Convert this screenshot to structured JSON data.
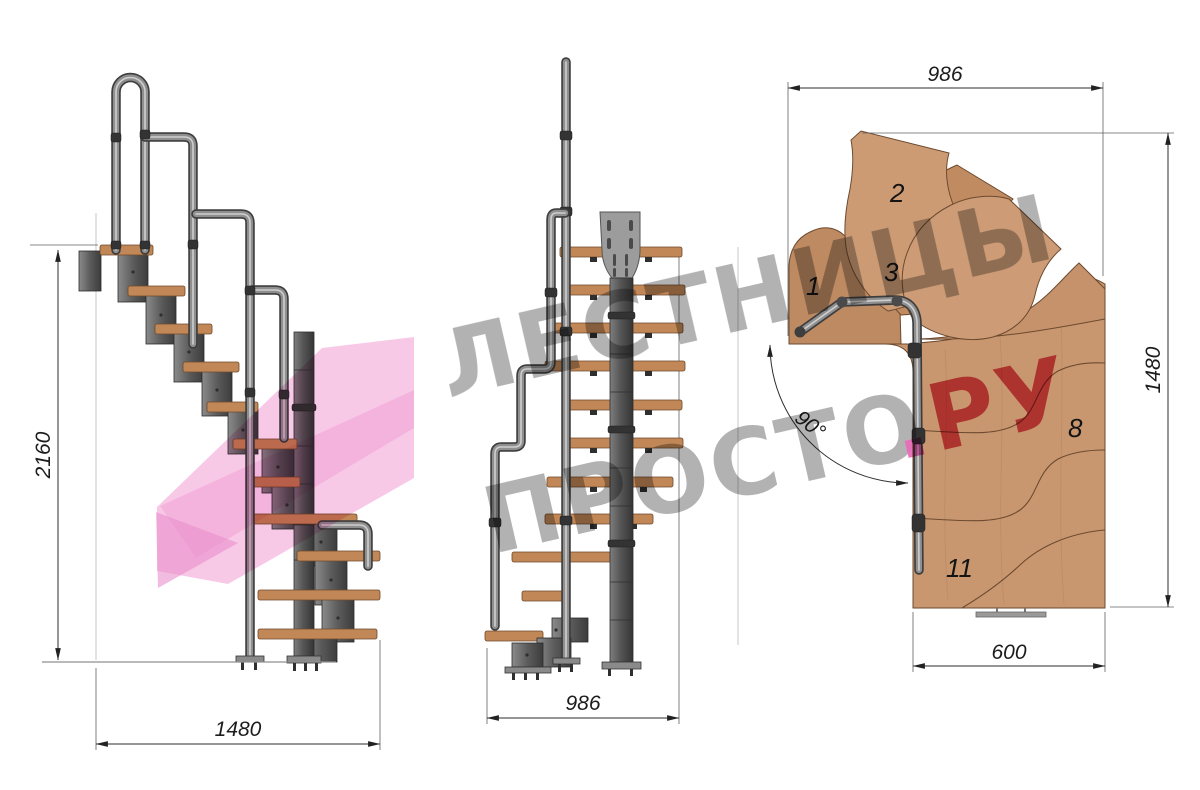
{
  "document": {
    "type": "staircase-assembly-drawing",
    "background": "#ffffff"
  },
  "views": {
    "side": {
      "dim_height": "2160",
      "dim_width": "1480"
    },
    "front": {
      "dim_width": "986"
    },
    "plan": {
      "dim_top": "986",
      "dim_right": "1480",
      "dim_bottom": "600",
      "angle_label": "90°",
      "step_numbers": {
        "n1": "1",
        "n2": "2",
        "n3": "3",
        "n8": "8",
        "n11": "11"
      }
    }
  },
  "watermark": {
    "line1": "ЛЕСТНИЦЫ",
    "line2_gray": "ПРОСТО",
    "line2_dot": ".",
    "line2_red": "РУ",
    "gray": "#a8a8a8",
    "red": "#d9475c",
    "dot_pink": "#ea6ab8",
    "arrow_pink": "#f7c3e4"
  },
  "colors": {
    "wood": "#c18756",
    "wood_plan": "#c9976f",
    "wood_edge": "#6d4a2f",
    "metal_dark": "#3d3d3d",
    "metal_mid": "#8f8f8f",
    "dim_line": "#2e2e2e"
  }
}
